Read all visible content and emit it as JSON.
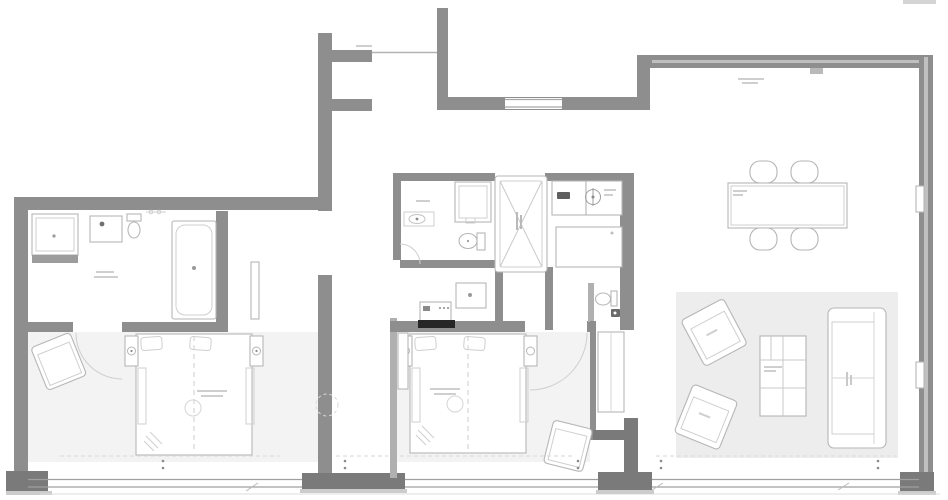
{
  "plan": {
    "type": "apartment floor plan, top view, grayscale CAD drawing",
    "legible_text": [],
    "note": "all annotation text in the source image is below legibility (micro gray marks)",
    "colors": {
      "wall": "#8e8e8e",
      "wall-dark": "#7a7a7a",
      "wall-step": "#cccccc",
      "thin-wall": "#b0b0b0",
      "outline": "#b6b6b6",
      "detail": "#cfcfcf",
      "faint": "#dedede",
      "floor": "#f3f3f3",
      "rug": "#ededed",
      "accent": "#262626",
      "fixture": "#5f5f5f",
      "bg": "#ffffff"
    },
    "rooms": [
      {
        "label": "bathroom-1",
        "fixtures": [
          "shower",
          "vanity-sink",
          "toilet",
          "bathtub",
          "door-leaf"
        ]
      },
      {
        "label": "bedroom-1",
        "fixtures": [
          "double-bed",
          "pillows",
          "nightstand-lamp-left",
          "nightstand-lamp-right",
          "armchair",
          "door-swing-arc",
          "window-sill"
        ]
      },
      {
        "label": "entry-corridor",
        "fixtures": [
          "entry-line",
          "section-circle-marker"
        ]
      },
      {
        "label": "bathroom-2",
        "fixtures": [
          "shower",
          "sink",
          "toilet",
          "door-swing-arc"
        ]
      },
      {
        "label": "service-shaft",
        "fixtures": [
          "cross-brace"
        ]
      },
      {
        "label": "kitchen",
        "fixtures": [
          "counter",
          "sink-basin",
          "cooktop-burner",
          "island",
          "wc-toilet",
          "wc-basin"
        ]
      },
      {
        "label": "hallway",
        "fixtures": [
          "washing-machine",
          "appliance"
        ]
      },
      {
        "label": "bedroom-2",
        "fixtures": [
          "double-bed",
          "pillows",
          "nightstand-lamp-left",
          "nightstand-lamp-right",
          "tv",
          "radiator",
          "armchair",
          "wardrobe",
          "door-swing-arc"
        ]
      },
      {
        "label": "living-dining",
        "fixtures": [
          "dining-table",
          "chair",
          "chair",
          "chair",
          "chair",
          "rug",
          "armchair",
          "armchair",
          "coffee-table",
          "sofa",
          "wall-vent"
        ]
      }
    ]
  }
}
